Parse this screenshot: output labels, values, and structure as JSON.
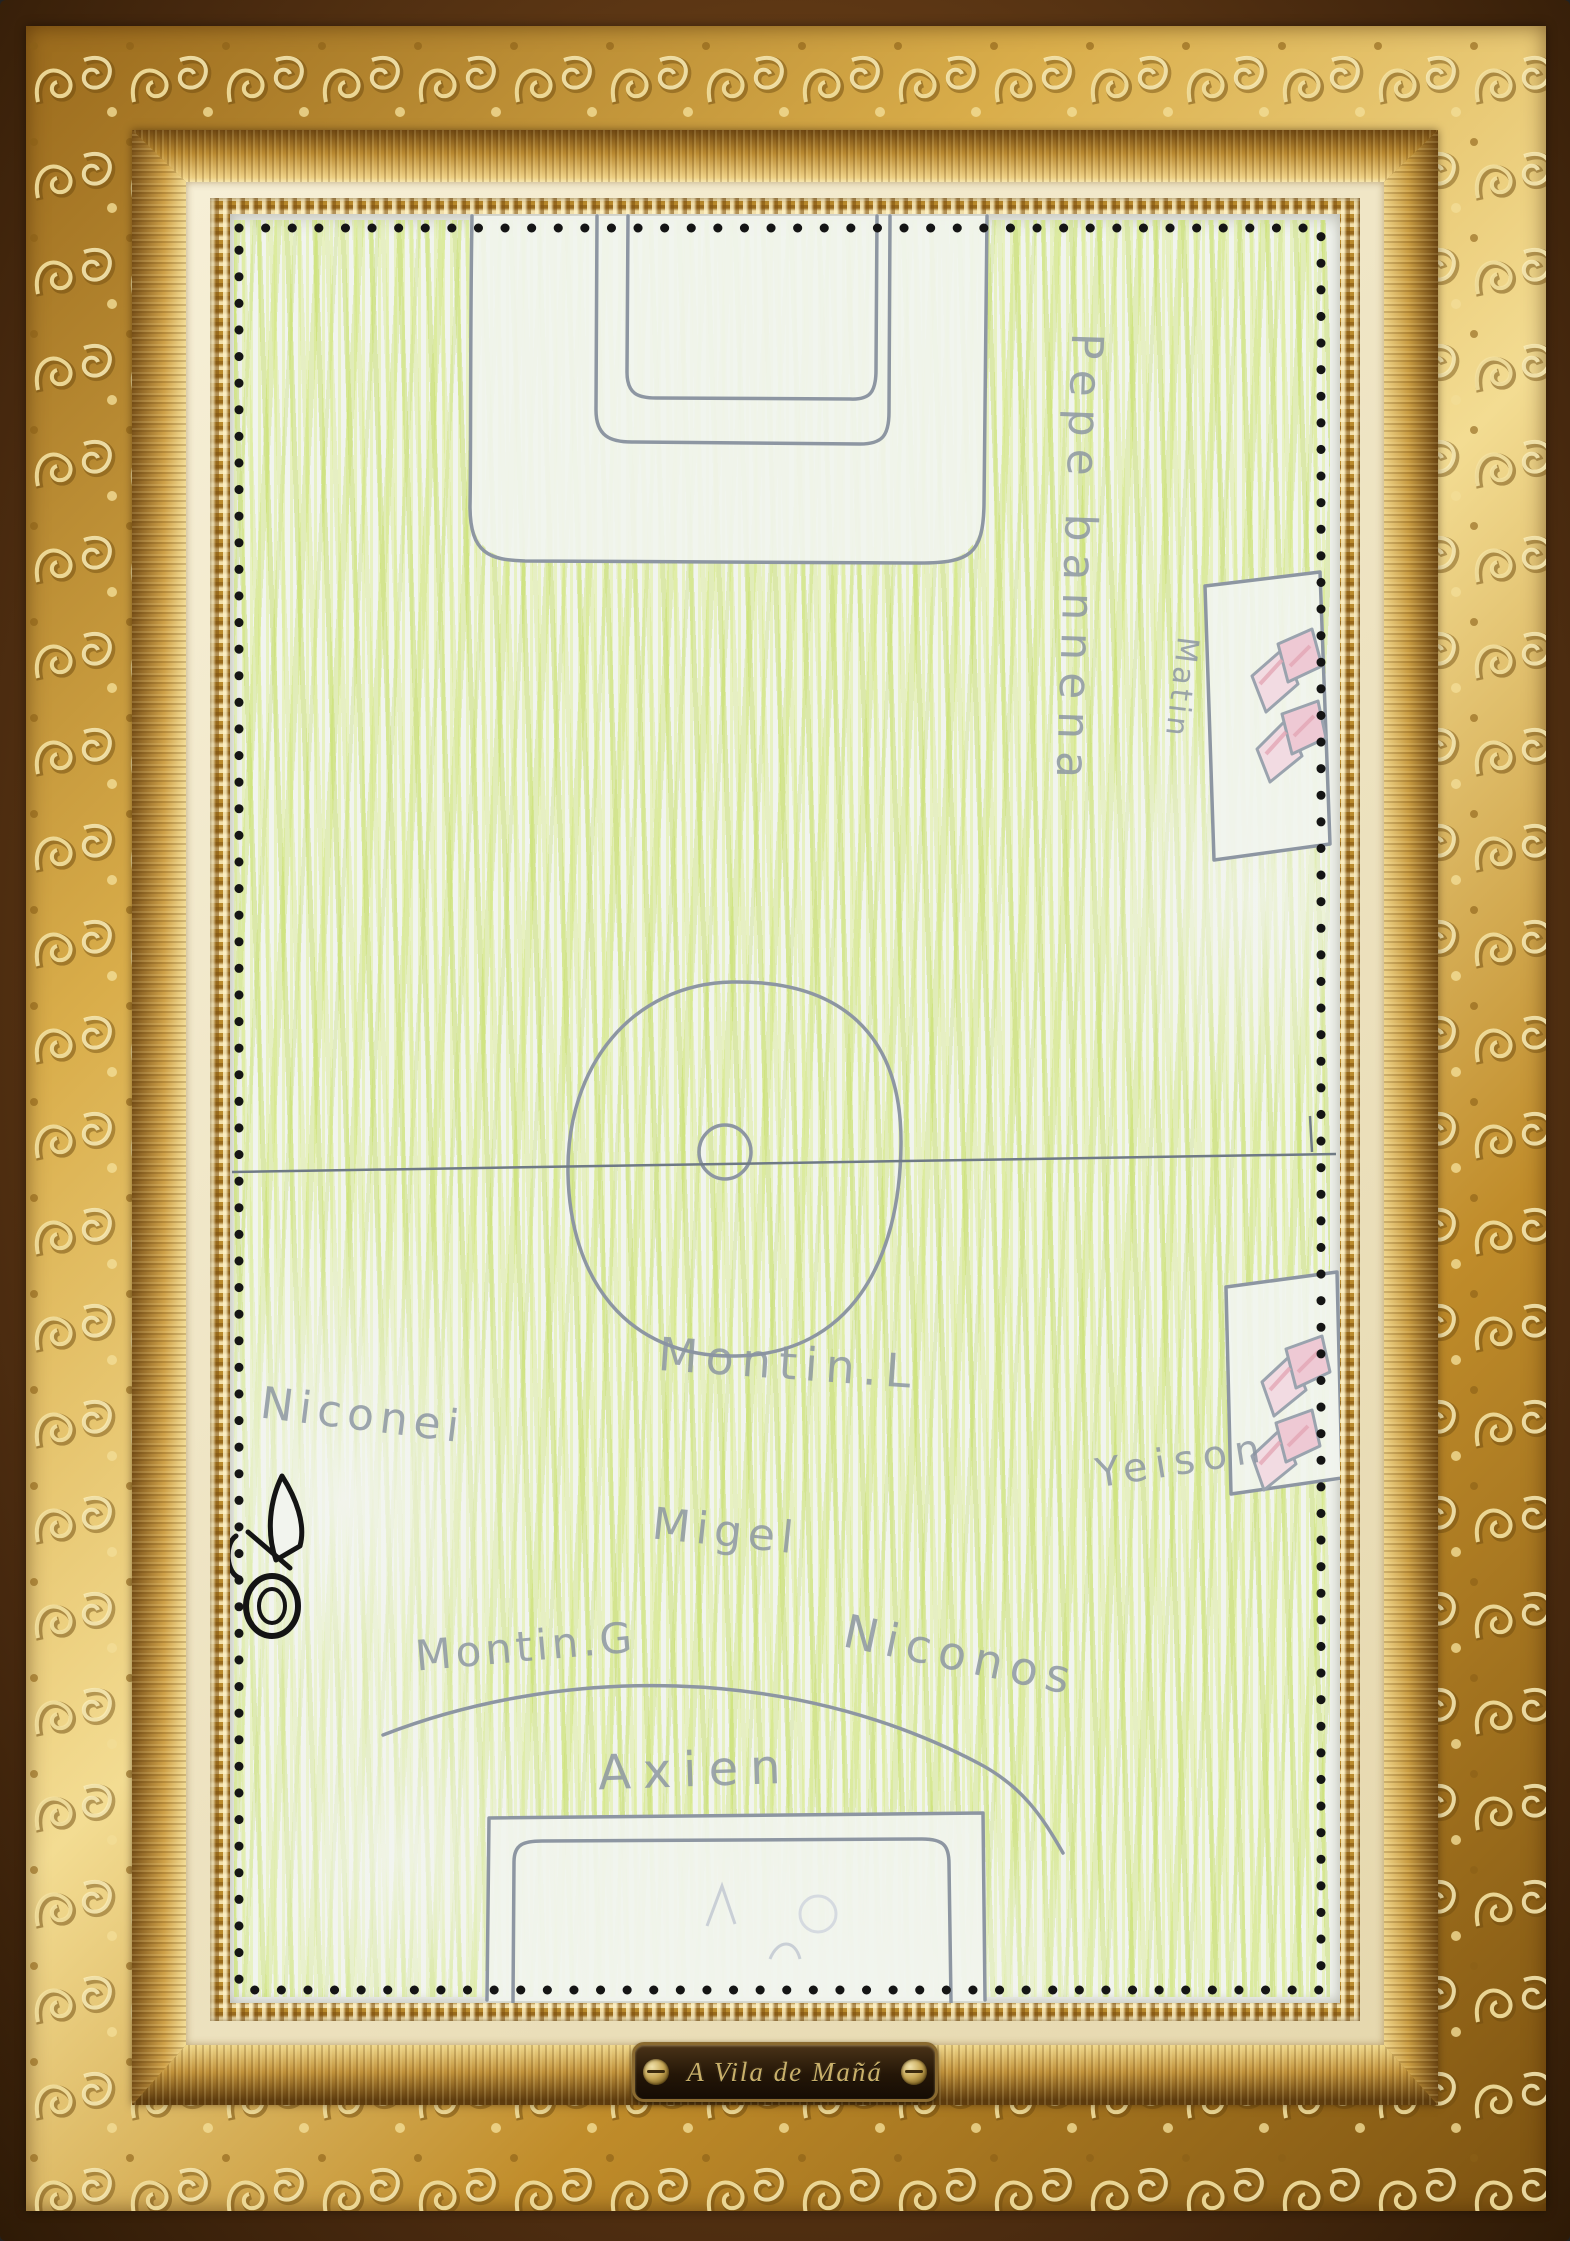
{
  "artwork": {
    "description_label": "child's crayon drawing of a football pitch",
    "names": {
      "pepe": "Pepe bannena",
      "matin": "Matin",
      "montin_l": "Montin.L",
      "niconei": "Niconei",
      "migel": "Migel",
      "montin_g": "Montin.G",
      "niconos": "Niconos",
      "axien": "Axien",
      "yeison": "Yeison"
    }
  },
  "plaque": {
    "text": "A Vila de Mañá"
  },
  "icons": {
    "scissors": "✂",
    "screw": "●"
  },
  "colors": {
    "crayon_green": "#cde27e",
    "pencil_gray": "#8d96a2",
    "halfway_line": "#6f7a85",
    "flag_pink": "#eecdd6",
    "paper": "#f1f4ee",
    "dot_black": "#151515",
    "frame_gold": "#d9ad4a",
    "frame_brown": "#46280e",
    "liner_cream": "#f0e7cb",
    "plaque_bronze": "#241607",
    "plaque_text_gold": "#c9b06a"
  }
}
